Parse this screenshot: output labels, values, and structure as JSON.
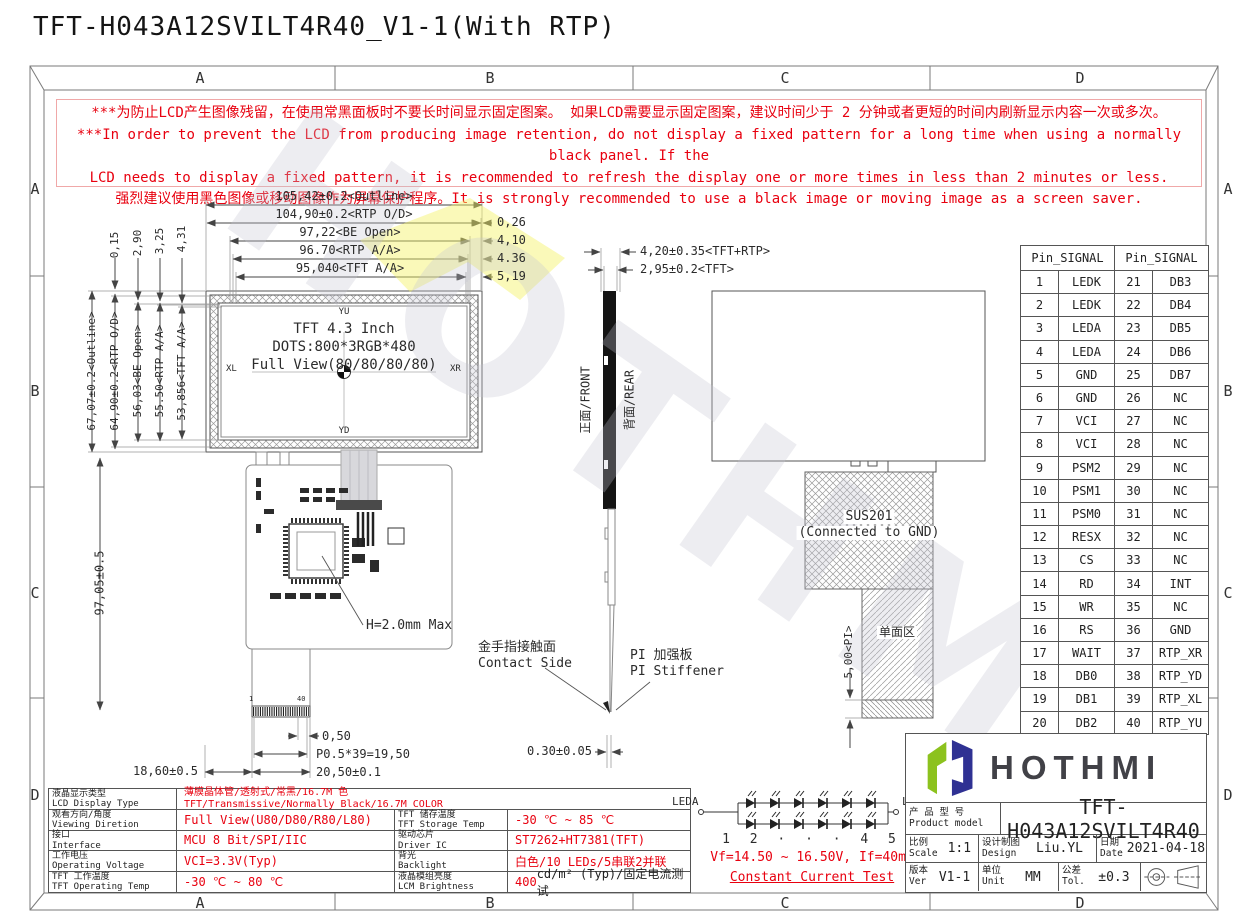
{
  "page_title": "TFT-H043A12SVILT4R40_V1-1(With RTP)",
  "zones": [
    "A",
    "B",
    "C",
    "D"
  ],
  "warning": {
    "line1": "***为防止LCD产生图像残留，在使用常黑面板时不要长时间显示固定图案。 如果LCD需要显示固定图案，建议时间少于 2 分钟或者更短的时间内刷新显示内容一次或多次。",
    "line2": "***In order to prevent the LCD from producing image retention, do not display a fixed pattern for a long time when using a normally black panel. If the",
    "line3": "LCD needs to display a fixed pattern, it is recommended to refresh the display one or more times in less than 2 minutes or less.",
    "line4": "强烈建议使用黑色图像或移动图像作为屏幕保护程序。It is strongly recommended to use a black image or moving image as a screen saver."
  },
  "front_view": {
    "dim_outline_w": "105,42±0.2<Outline>",
    "dim_rtp_od_w": "104,90±0.2<RTP O/D>",
    "dim_be_open_w": "97,22<BE Open>",
    "dim_rtp_aa_w": "96.70<RTP A/A>",
    "dim_tft_aa_w": "95,040<TFT A/A>",
    "gap_1": "0,26",
    "gap_2": "4,10",
    "gap_3": "4.36",
    "gap_4": "5,19",
    "off_1": "0,15",
    "off_2": "2,90",
    "off_3": "3,25",
    "off_4": "4,31",
    "dim_outline_h": "67,07±0.2<Outline>",
    "dim_rtp_od_h": "64,90±0.2<RTP O/D>",
    "dim_be_open_h": "56,03<BE Open>",
    "dim_rtp_aa_h": "55.50<RTP A/A>",
    "dim_tft_aa_h": "53,856<TFT A/A>",
    "dim_total_h": "97,05±0.5",
    "display_line1": "TFT 4.3 Inch",
    "display_line2": "DOTS:800*3RGB*480",
    "display_line3": "Full View(80/80/80/80)",
    "corner_top": "YU",
    "corner_left": "XL",
    "corner_right": "XR",
    "corner_bottom": "YD",
    "h_max": "H=2.0mm Max",
    "pin_first": "1",
    "pin_last": "40",
    "dim_pin_margin": "0,50",
    "dim_pitch": "P0.5*39=19,50",
    "dim_connector_w": "20,50±0.1",
    "dim_tail_offset": "18,60±0.5",
    "contact_zh": "金手指接触面",
    "contact_en": "Contact Side",
    "stiffener_zh": "PI 加强板",
    "stiffener_en": "PI Stiffener",
    "dim_fpc_thickness": "0.30±0.05"
  },
  "side_view": {
    "dim_total": "4,20±0.35<TFT+RTP>",
    "dim_tft": "2,95±0.2<TFT>",
    "front_label": "正面/FRONT",
    "rear_label": "背面/REAR"
  },
  "rear_view": {
    "sus_line1": "SUS201",
    "sus_line2": "(Connected to GND)",
    "dim_pi": "5,00<PI>",
    "single_side_area": "单面区"
  },
  "pin_table": {
    "header": "Pin_SIGNAL",
    "rows": [
      [
        "1",
        "LEDK",
        "21",
        "DB3"
      ],
      [
        "2",
        "LEDK",
        "22",
        "DB4"
      ],
      [
        "3",
        "LEDA",
        "23",
        "DB5"
      ],
      [
        "4",
        "LEDA",
        "24",
        "DB6"
      ],
      [
        "5",
        "GND",
        "25",
        "DB7"
      ],
      [
        "6",
        "GND",
        "26",
        "NC"
      ],
      [
        "7",
        "VCI",
        "27",
        "NC"
      ],
      [
        "8",
        "VCI",
        "28",
        "NC"
      ],
      [
        "9",
        "PSM2",
        "29",
        "NC"
      ],
      [
        "10",
        "PSM1",
        "30",
        "NC"
      ],
      [
        "11",
        "PSM0",
        "31",
        "NC"
      ],
      [
        "12",
        "RESX",
        "32",
        "NC"
      ],
      [
        "13",
        "CS",
        "33",
        "NC"
      ],
      [
        "14",
        "RD",
        "34",
        "INT"
      ],
      [
        "15",
        "WR",
        "35",
        "NC"
      ],
      [
        "16",
        "RS",
        "36",
        "GND"
      ],
      [
        "17",
        "WAIT",
        "37",
        "RTP_XR"
      ],
      [
        "18",
        "DB0",
        "38",
        "RTP_YD"
      ],
      [
        "19",
        "DB1",
        "39",
        "RTP_XL"
      ],
      [
        "20",
        "DB2",
        "40",
        "RTP_YU"
      ]
    ]
  },
  "spec_table": {
    "row1": {
      "label_zh": "液晶显示类型",
      "label_en": "LCD Display Type",
      "value_zh": "薄膜晶体管/透射式/常黑/16.7M 色",
      "value_en": "TFT/Transmissive/Normally Black/16.7M COLOR"
    },
    "row2": {
      "label_zh": "观看方向/角度",
      "label_en": "Viewing Diretion",
      "value": "Full View(U80/D80/R80/L80)",
      "label2_zh": "TFT 储存温度",
      "label2_en": "TFT Storage Temp",
      "value2": "-30 ℃ ~ 85 ℃"
    },
    "row3": {
      "label_zh": "接口",
      "label_en": "Interface",
      "value": "MCU 8 Bit/SPI/IIC",
      "label2_zh": "驱动芯片",
      "label2_en": "Driver IC",
      "value2": "ST7262+HT7381(TFT)"
    },
    "row4": {
      "label_zh": "工作电压",
      "label_en": "Operating Voltage",
      "value": "VCI=3.3V(Typ)",
      "label2_zh": "背光",
      "label2_en": "Backlight",
      "value2": "白色/10 LEDs/5串联2并联"
    },
    "row5": {
      "label_zh": "TFT 工作温度",
      "label_en": "TFT Operating Temp",
      "value": "-30 ℃ ~ 80 ℃",
      "label2_zh": "液晶模组亮度",
      "label2_en": "LCM Brightness",
      "value2_num": "400",
      "value2_rest": " cd/m² (Typ)/固定电流测试"
    }
  },
  "led_circuit": {
    "anode": "LEDA",
    "cathode": "LEDK",
    "index_row": "1    2   ·  ·  ·   4    5",
    "spec": "Vf=14.50 ~ 16.50V, If=40mA",
    "note": "Constant Current Test"
  },
  "title_block": {
    "brand": "HOTHMI",
    "model_label_zh": "产 品 型 号",
    "model_label_en": "Product model",
    "model": "TFT-H043A12SVILT4R40",
    "scale_zh": "比例",
    "scale_en": "Scale",
    "scale": "1:1",
    "design_zh": "设计制图",
    "design_en": "Design",
    "designer": "Liu.YL",
    "date_zh": "日期",
    "date_en": "Date",
    "date": "2021-04-18",
    "ver_zh": "版本",
    "ver_en": "Ver",
    "ver": "V1-1",
    "unit_zh": "单位",
    "unit_en": "Unit",
    "unit": "MM",
    "tol_zh": "公差",
    "tol_en": "Tol.",
    "tol": "±0.3"
  },
  "colors": {
    "red": "#e8000f",
    "logo_green": "#8cc21e",
    "logo_navy": "#2f3193"
  }
}
